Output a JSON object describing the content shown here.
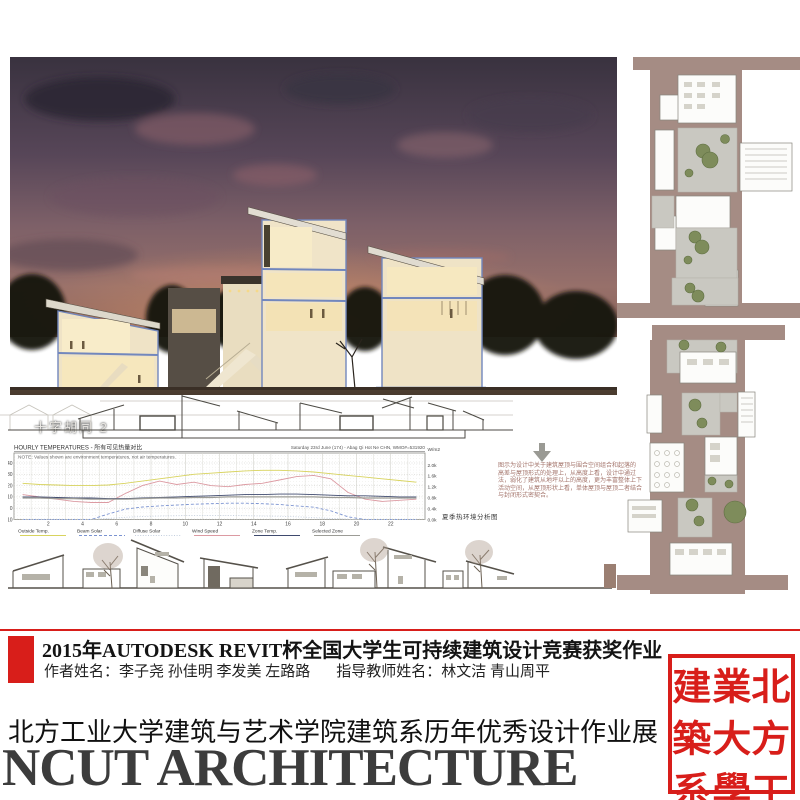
{
  "poster": {
    "render": {
      "caption": "十字胡同 2"
    },
    "summer_label": "夏季热环境分析图",
    "side_note": {
      "lines": [
        "图示为设计中关于建筑屋顶与围合空间组合和起落的",
        "高差与屋顶形式的处理上，从高度上看，设计中通过",
        "法，弱化了建筑从地坪以上的高度，更为丰富整体上下",
        "活动空间，从屋顶形状上看，单体屋顶与屋顶二者结合",
        "与封闭形式密契合。"
      ]
    },
    "footer": {
      "accent_red": "#d81e1a",
      "line1": "2015年AUTODESK REVIT杯全国大学生可持续建筑设计竞赛获奖作业",
      "line2_author": "作者姓名：李子尧 孙佳明 李发美 左路路",
      "line2_teacher": "指导教师姓名：林文洁 青山周平",
      "dept_line": "北方工业大学建筑与艺术学院建筑系历年优秀设计作业展",
      "ncut": "NCUT ARCHITECTURE",
      "seal_chars": [
        "建",
        "業",
        "北",
        "築",
        "大",
        "方",
        "系",
        "學",
        "工"
      ]
    }
  },
  "chart_data": {
    "type": "line",
    "title": "HOURLY TEMPERATURES - 所有可见热量对比",
    "subtitle": "Saturday 23rd June (174) - Abag Qi Hot Ne CHN, WMO#=531920",
    "note": "NOTE: Values shown are environment temperatures, not air temperatures.",
    "right_axis_unit": "W/m2",
    "left_axis": {
      "ticks": [
        40,
        30,
        20,
        10,
        0,
        -10
      ],
      "unit": "C"
    },
    "right_axis": {
      "ticks": [
        "2.0k",
        "1.6k",
        "1.2k",
        "0.8k",
        "0.4k",
        "0.0k"
      ]
    },
    "x_ticks": [
      2,
      4,
      6,
      8,
      10,
      12,
      14,
      16,
      18,
      20,
      22
    ],
    "hours": 24,
    "grid": true,
    "legend_position": "bottom",
    "series": [
      {
        "name": "Outside Temp.",
        "axis": "temp",
        "style": "solid",
        "color": "#d8d35e",
        "values": [
          22,
          21,
          20.5,
          20,
          20,
          20.5,
          22,
          24,
          26,
          28,
          30,
          31,
          32,
          33,
          33.5,
          33.5,
          33,
          32,
          30.5,
          29,
          27.5,
          26,
          24.5,
          23
        ]
      },
      {
        "name": "Beam Solar",
        "axis": "solar",
        "style": "dashed",
        "color": "#7b93d1",
        "values": [
          0,
          0,
          0,
          0,
          0,
          0.2,
          0.38,
          0.46,
          0.5,
          0.53,
          0.56,
          0.58,
          0.6,
          0.6,
          0.58,
          0.55,
          0.5,
          0.45,
          0.32,
          0.1,
          0,
          0,
          0,
          0
        ]
      },
      {
        "name": "Diffuse Solar",
        "axis": "solar",
        "style": "dotted",
        "color": "#c3cede",
        "values": [
          0,
          0,
          0,
          0,
          0,
          0.04,
          0.08,
          0.11,
          0.13,
          0.14,
          0.15,
          0.15,
          0.15,
          0.14,
          0.13,
          0.12,
          0.1,
          0.07,
          0.04,
          0.01,
          0,
          0,
          0,
          0
        ]
      },
      {
        "name": "Wind Speed",
        "axis": "temp",
        "style": "solid",
        "color": "#dc9aa2",
        "values": [
          12,
          10,
          8,
          6,
          5,
          5,
          13,
          20,
          24,
          21,
          23,
          20,
          19,
          21,
          22,
          25,
          28,
          29,
          26,
          14,
          8,
          6,
          7,
          8
        ]
      },
      {
        "name": "Zone Temp.",
        "axis": "temp",
        "style": "solid",
        "color": "#3f4a6e",
        "values": [
          10,
          10,
          9.5,
          9,
          9,
          8.5,
          8.5,
          9,
          9.5,
          10,
          10.5,
          11,
          11.5,
          12,
          12,
          12.5,
          12.5,
          12,
          11.5,
          11,
          11,
          10.5,
          10,
          10
        ]
      },
      {
        "name": "Selected Zone",
        "axis": "temp",
        "style": "solid",
        "color": "#9c9c96",
        "values": [
          9,
          9,
          8.5,
          8.5,
          8,
          8,
          8,
          8.5,
          9,
          9,
          9.5,
          9.5,
          10,
          10,
          10,
          10,
          10,
          10,
          9.5,
          9.5,
          9,
          9,
          9,
          9
        ]
      }
    ]
  }
}
